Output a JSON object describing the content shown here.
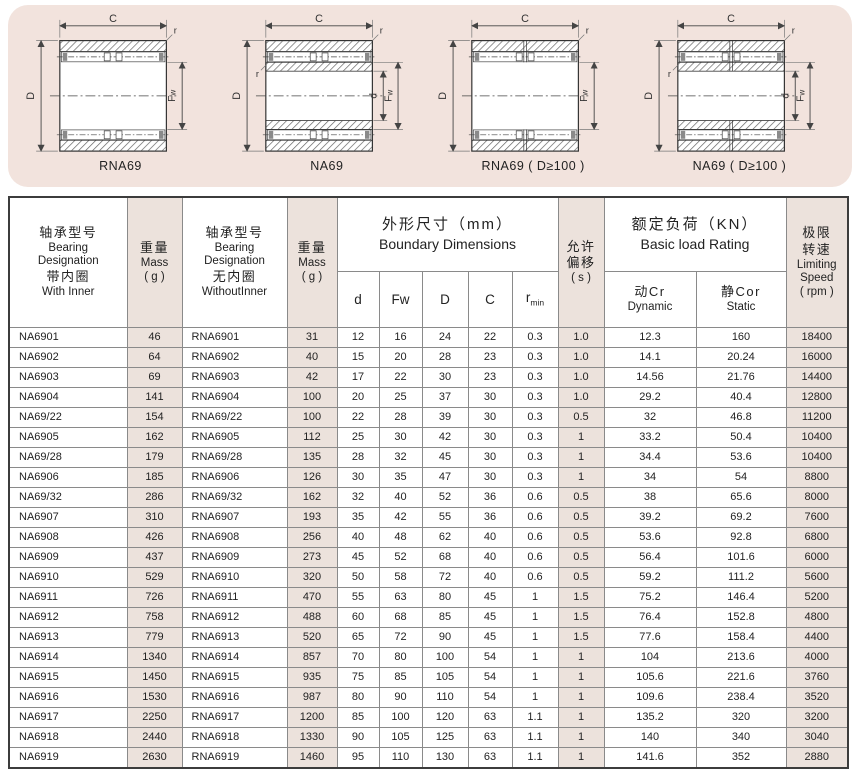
{
  "diagram_panel": {
    "bg": "#f2e3dd",
    "dim_labels": {
      "c": "C",
      "D": "D",
      "fw_main": "F",
      "fw_sub": "w",
      "d": "d",
      "r": "r"
    },
    "diagrams": [
      {
        "caption": "RNA69",
        "inner_ring": false,
        "split": false
      },
      {
        "caption": "NA69",
        "inner_ring": true,
        "split": false
      },
      {
        "caption": "RNA69 ( D≥100 )",
        "inner_ring": false,
        "split": true
      },
      {
        "caption": "NA69 ( D≥100 )",
        "inner_ring": true,
        "split": true
      }
    ]
  },
  "table": {
    "accent_bg": "#ece2dc",
    "header": {
      "with_inner": {
        "zh": "轴承型号",
        "en1": "Bearing",
        "en2": "Designation",
        "zh2": "带内圈",
        "en3": "With Inner"
      },
      "mass1": {
        "zh": "重量",
        "en": "Mass",
        "unit": "( g )"
      },
      "without_inner": {
        "zh": "轴承型号",
        "en1": "Bearing",
        "en2": "Designation",
        "zh2": "无内圈",
        "en3": "WithoutInner"
      },
      "mass2": {
        "zh": "重量",
        "en": "Mass",
        "unit": "( g )"
      },
      "boundary": {
        "zh": "外形尺寸（mm）",
        "en": "Boundary Dimensions"
      },
      "dims": {
        "d": "d",
        "fw": "Fw",
        "D": "D",
        "C": "C",
        "r": "r",
        "r_sub": "min"
      },
      "offset": {
        "zh1": "允许",
        "zh2": "偏移",
        "unit": "( s )"
      },
      "load": {
        "zh": "额定负荷（KN）",
        "en": "Basic load Rating"
      },
      "dynamic": {
        "zh": "动Cr",
        "en": "Dynamic"
      },
      "static": {
        "zh": "静Cor",
        "en": "Static"
      },
      "speed": {
        "zh1": "极限",
        "zh2": "转速",
        "en1": "Limiting",
        "en2": "Speed",
        "unit": "( rpm )"
      }
    },
    "pink_columns": [
      1,
      3,
      9,
      12
    ],
    "rows": [
      [
        "NA6901",
        "46",
        "RNA6901",
        "31",
        "12",
        "16",
        "24",
        "22",
        "0.3",
        "1.0",
        "12.3",
        "160",
        "18400"
      ],
      [
        "NA6902",
        "64",
        "RNA6902",
        "40",
        "15",
        "20",
        "28",
        "23",
        "0.3",
        "1.0",
        "14.1",
        "20.24",
        "16000"
      ],
      [
        "NA6903",
        "69",
        "RNA6903",
        "42",
        "17",
        "22",
        "30",
        "23",
        "0.3",
        "1.0",
        "14.56",
        "21.76",
        "14400"
      ],
      [
        "NA6904",
        "141",
        "RNA6904",
        "100",
        "20",
        "25",
        "37",
        "30",
        "0.3",
        "1.0",
        "29.2",
        "40.4",
        "12800"
      ],
      [
        "NA69/22",
        "154",
        "RNA69/22",
        "100",
        "22",
        "28",
        "39",
        "30",
        "0.3",
        "0.5",
        "32",
        "46.8",
        "11200"
      ],
      [
        "NA6905",
        "162",
        "RNA6905",
        "112",
        "25",
        "30",
        "42",
        "30",
        "0.3",
        "1",
        "33.2",
        "50.4",
        "10400"
      ],
      [
        "NA69/28",
        "179",
        "RNA69/28",
        "135",
        "28",
        "32",
        "45",
        "30",
        "0.3",
        "1",
        "34.4",
        "53.6",
        "10400"
      ],
      [
        "NA6906",
        "185",
        "RNA6906",
        "126",
        "30",
        "35",
        "47",
        "30",
        "0.3",
        "1",
        "34",
        "54",
        "8800"
      ],
      [
        "NA69/32",
        "286",
        "RNA69/32",
        "162",
        "32",
        "40",
        "52",
        "36",
        "0.6",
        "0.5",
        "38",
        "65.6",
        "8000"
      ],
      [
        "NA6907",
        "310",
        "RNA6907",
        "193",
        "35",
        "42",
        "55",
        "36",
        "0.6",
        "0.5",
        "39.2",
        "69.2",
        "7600"
      ],
      [
        "NA6908",
        "426",
        "RNA6908",
        "256",
        "40",
        "48",
        "62",
        "40",
        "0.6",
        "0.5",
        "53.6",
        "92.8",
        "6800"
      ],
      [
        "NA6909",
        "437",
        "RNA6909",
        "273",
        "45",
        "52",
        "68",
        "40",
        "0.6",
        "0.5",
        "56.4",
        "101.6",
        "6000"
      ],
      [
        "NA6910",
        "529",
        "RNA6910",
        "320",
        "50",
        "58",
        "72",
        "40",
        "0.6",
        "0.5",
        "59.2",
        "111.2",
        "5600"
      ],
      [
        "NA6911",
        "726",
        "RNA6911",
        "470",
        "55",
        "63",
        "80",
        "45",
        "1",
        "1.5",
        "75.2",
        "146.4",
        "5200"
      ],
      [
        "NA6912",
        "758",
        "RNA6912",
        "488",
        "60",
        "68",
        "85",
        "45",
        "1",
        "1.5",
        "76.4",
        "152.8",
        "4800"
      ],
      [
        "NA6913",
        "779",
        "RNA6913",
        "520",
        "65",
        "72",
        "90",
        "45",
        "1",
        "1.5",
        "77.6",
        "158.4",
        "4400"
      ],
      [
        "NA6914",
        "1340",
        "RNA6914",
        "857",
        "70",
        "80",
        "100",
        "54",
        "1",
        "1",
        "104",
        "213.6",
        "4000"
      ],
      [
        "NA6915",
        "1450",
        "RNA6915",
        "935",
        "75",
        "85",
        "105",
        "54",
        "1",
        "1",
        "105.6",
        "221.6",
        "3760"
      ],
      [
        "NA6916",
        "1530",
        "RNA6916",
        "987",
        "80",
        "90",
        "110",
        "54",
        "1",
        "1",
        "109.6",
        "238.4",
        "3520"
      ],
      [
        "NA6917",
        "2250",
        "RNA6917",
        "1200",
        "85",
        "100",
        "120",
        "63",
        "1.1",
        "1",
        "135.2",
        "320",
        "3200"
      ],
      [
        "NA6918",
        "2440",
        "RNA6918",
        "1330",
        "90",
        "105",
        "125",
        "63",
        "1.1",
        "1",
        "140",
        "340",
        "3040"
      ],
      [
        "NA6919",
        "2630",
        "RNA6919",
        "1460",
        "95",
        "110",
        "130",
        "63",
        "1.1",
        "1",
        "141.6",
        "352",
        "2880"
      ]
    ]
  }
}
